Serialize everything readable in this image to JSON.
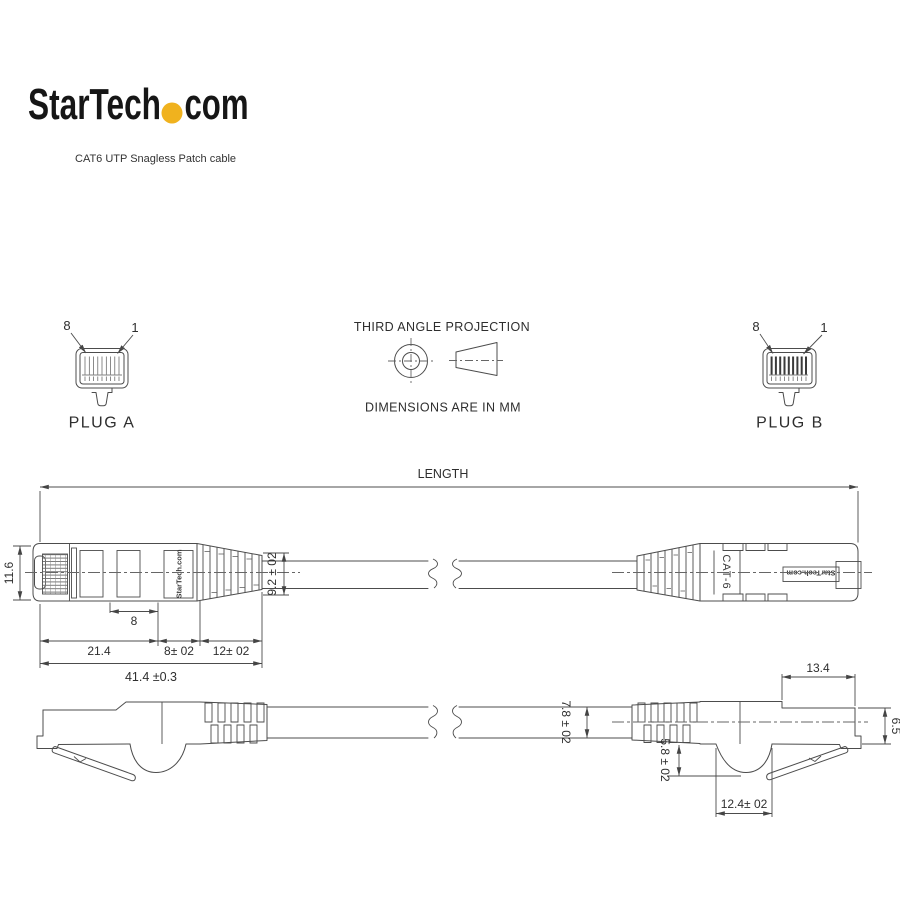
{
  "brand": {
    "logo_text_1": "StarTech",
    "logo_text_2": "com",
    "dot_color": "#F0B21E",
    "subtitle": "CAT6 UTP Snagless Patch cable"
  },
  "header": {
    "projection_title": "THIRD ANGLE PROJECTION",
    "units_note": "DIMENSIONS ARE IN MM"
  },
  "plug_a": {
    "label": "PLUG A",
    "pin_left": "8",
    "pin_right": "1"
  },
  "plug_b": {
    "label": "PLUG B",
    "pin_left": "8",
    "pin_right": "1"
  },
  "markings": {
    "connector_label": "CAT-6",
    "brand_marking_a": "StarTech.com",
    "brand_marking_b": "StarTech.com"
  },
  "dims": {
    "length": "LENGTH",
    "plug_height": "11.6",
    "contact_section": "8",
    "body_length": "21.4",
    "boot_section": "8± 02",
    "boot_taper": "12± 02",
    "overall_length": "41.4 ±0.3",
    "boot_diameter": "9.2 ± 02",
    "head_length": "13.4",
    "nose_height": "6.5",
    "cable_diameter": "7.8 ± 02",
    "latch_depth": "5.8 ± 02",
    "bump_width": "12.4± 02"
  }
}
